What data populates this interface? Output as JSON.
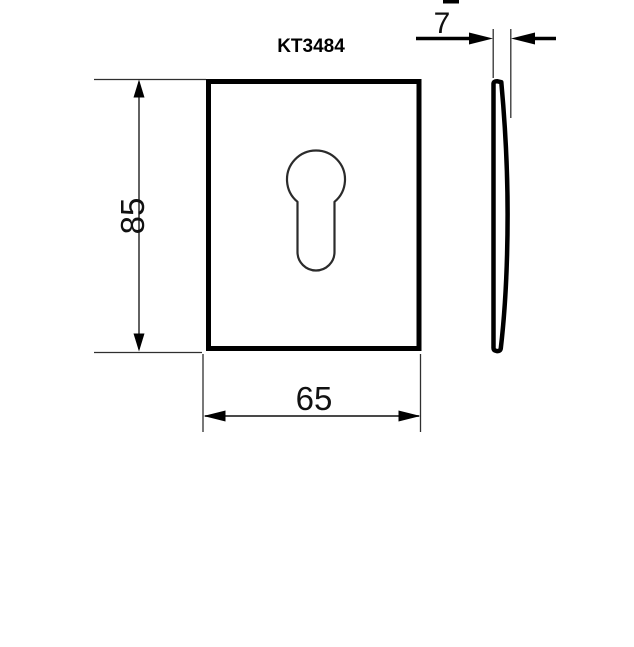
{
  "drawing": {
    "part_number": "KT3484",
    "front_view": {
      "height_label": "85",
      "width_label": "65",
      "feature": "euro-profile-keyhole-cutout"
    },
    "side_view": {
      "thickness_label": "7"
    },
    "colors": {
      "line": "#000000",
      "keyhole_stroke": "#2b2b2b",
      "background": "#ffffff"
    }
  }
}
